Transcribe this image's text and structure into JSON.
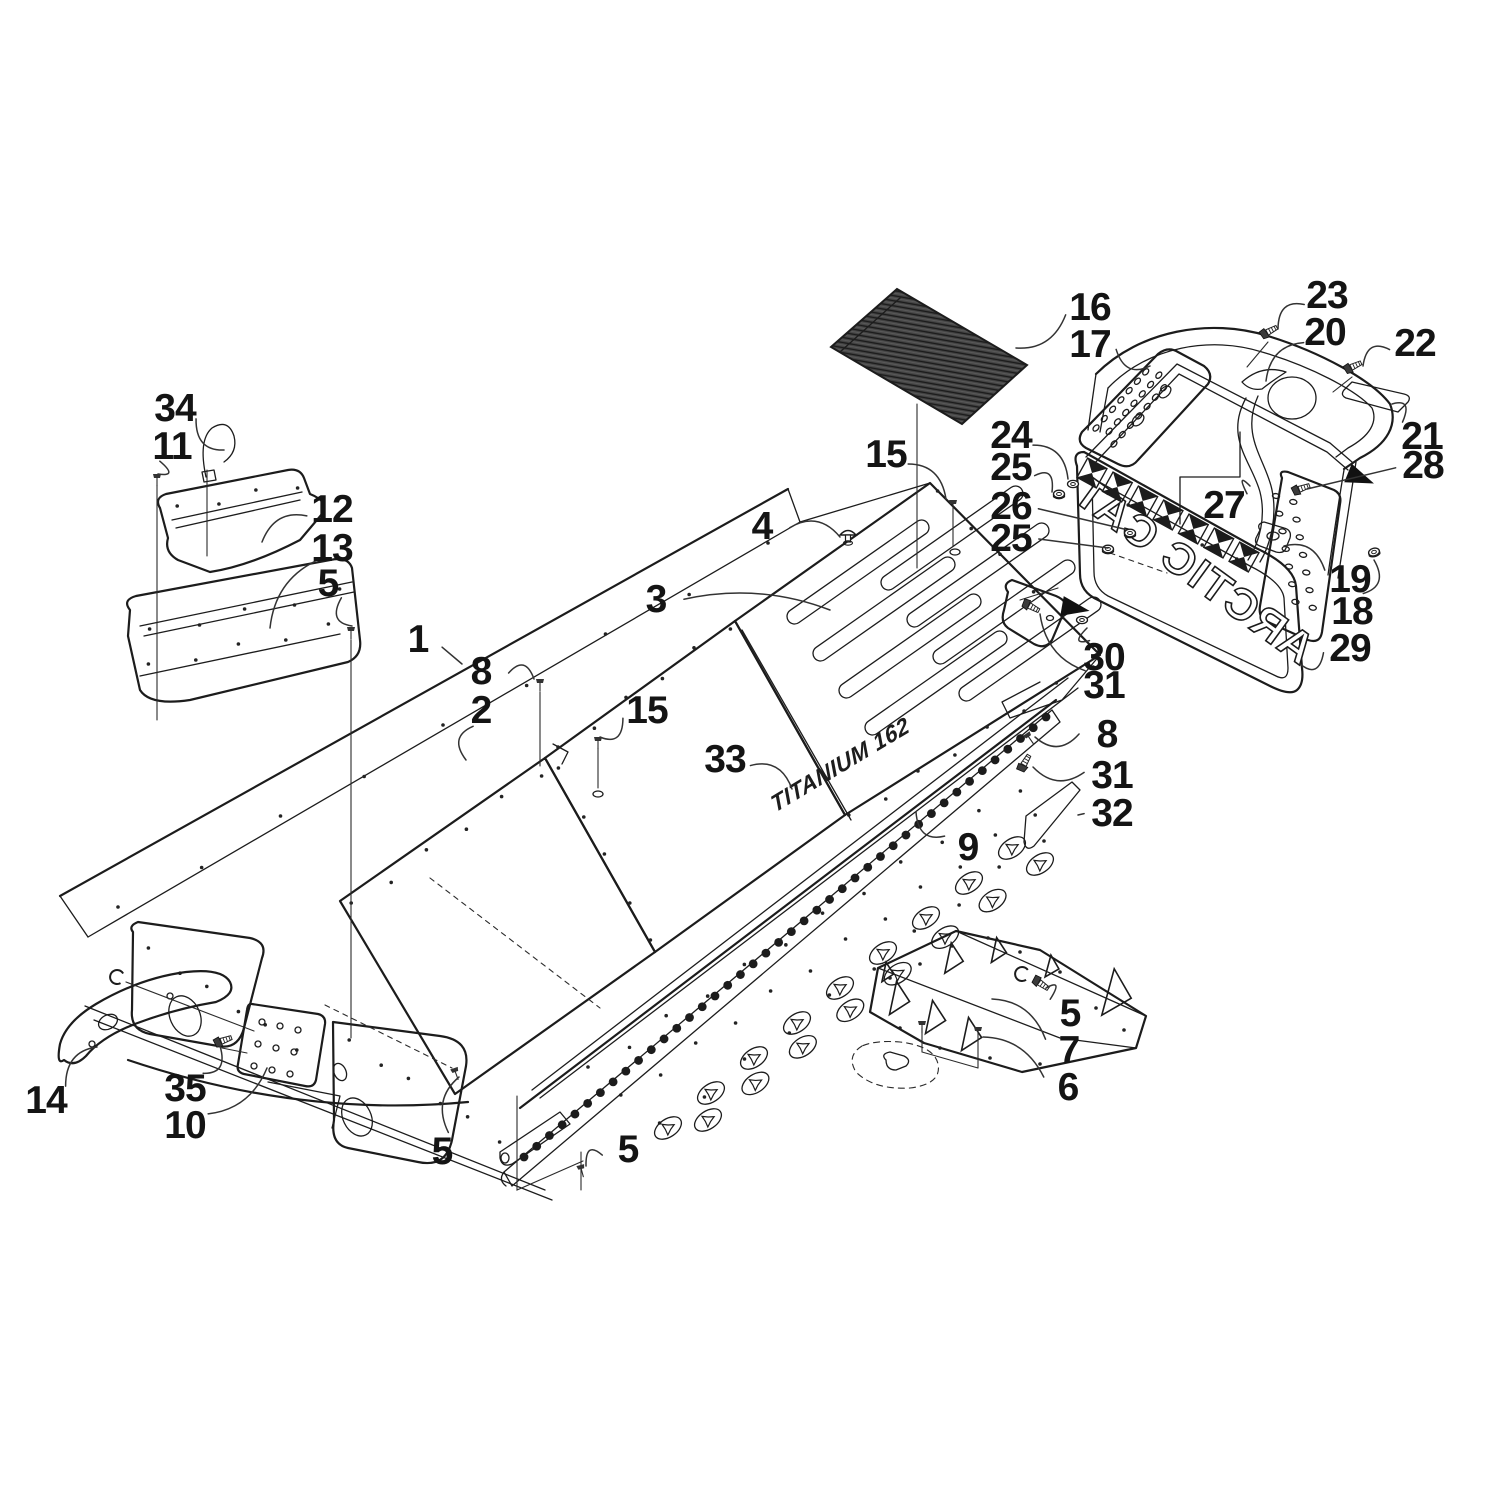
{
  "figure": {
    "type": "exploded-parts-diagram",
    "description": "Tunnel and rear bumper assembly exploded view line drawing",
    "background_color": "#ffffff",
    "line_color": "#1c1c1c",
    "mat_fill_color": "#474747",
    "mat_stripe_color": "#1a1a1a"
  },
  "decals": {
    "flap_logo": "ARCTIC CAT",
    "tunnel_decal": "TITANIUM 162"
  },
  "icons": [
    {
      "name": "direction-arrow-icon",
      "x": 1062,
      "y": 606,
      "angle": 10
    },
    {
      "name": "direction-arrow-icon",
      "x": 1348,
      "y": 473,
      "angle": 22
    }
  ],
  "callouts": [
    {
      "text": "34",
      "x": 175,
      "y": 407,
      "tx": 224,
      "ty": 450,
      "bend": 1
    },
    {
      "text": "11",
      "x": 172,
      "y": 445,
      "tx": 158,
      "ty": 474,
      "bend": -1
    },
    {
      "text": "12",
      "x": 332,
      "y": 508,
      "tx": 262,
      "ty": 542,
      "bend": 1
    },
    {
      "text": "13",
      "x": 332,
      "y": 547,
      "tx": 270,
      "ty": 628,
      "bend": 1
    },
    {
      "text": "5",
      "x": 328,
      "y": 582,
      "tx": 352,
      "ty": 626,
      "bend": 1
    },
    {
      "text": "1",
      "x": 418,
      "y": 638,
      "tx": 462,
      "ty": 664,
      "bend": 0
    },
    {
      "text": "8",
      "x": 481,
      "y": 670,
      "tx": 534,
      "ty": 679,
      "bend": -1
    },
    {
      "text": "2",
      "x": 481,
      "y": 709,
      "tx": 466,
      "ty": 760,
      "bend": 1
    },
    {
      "text": "15",
      "x": 647,
      "y": 709,
      "tx": 600,
      "ty": 737,
      "bend": -1
    },
    {
      "text": "3",
      "x": 656,
      "y": 598,
      "tx": 830,
      "ty": 610,
      "bend": -1
    },
    {
      "text": "4",
      "x": 762,
      "y": 525,
      "tx": 840,
      "ty": 537,
      "bend": -1
    },
    {
      "text": "15",
      "x": 886,
      "y": 453,
      "tx": 946,
      "ty": 499,
      "bend": -1
    },
    {
      "text": "16",
      "x": 1090,
      "y": 306,
      "tx": 1016,
      "ty": 348,
      "bend": -1
    },
    {
      "text": "17",
      "x": 1090,
      "y": 343,
      "tx": 1150,
      "ty": 366,
      "bend": 1
    },
    {
      "text": "23",
      "x": 1327,
      "y": 294,
      "tx": 1278,
      "ty": 329,
      "bend": 1
    },
    {
      "text": "20",
      "x": 1325,
      "y": 331,
      "tx": 1266,
      "ty": 381,
      "bend": 1
    },
    {
      "text": "22",
      "x": 1415,
      "y": 342,
      "tx": 1363,
      "ty": 366,
      "bend": 1
    },
    {
      "text": "21",
      "x": 1422,
      "y": 435,
      "tx": 1392,
      "ty": 404,
      "bend": 1
    },
    {
      "text": "28",
      "x": 1423,
      "y": 464,
      "tx": 1307,
      "ty": 489,
      "bend": 0
    },
    {
      "text": "24",
      "x": 1011,
      "y": 434,
      "tx": 1068,
      "ty": 479,
      "bend": -1
    },
    {
      "text": "25",
      "x": 1011,
      "y": 466,
      "tx": 1052,
      "ty": 492,
      "bend": -1
    },
    {
      "text": "26",
      "x": 1011,
      "y": 505,
      "tx": 1124,
      "ty": 529,
      "bend": 0
    },
    {
      "text": "25",
      "x": 1011,
      "y": 537,
      "tx": 1108,
      "ty": 548,
      "bend": 0
    },
    {
      "text": "27",
      "x": 1224,
      "y": 504,
      "tx": 1250,
      "ty": 486,
      "bend": -1
    },
    {
      "text": "19",
      "x": 1350,
      "y": 578,
      "tx": 1284,
      "ty": 546,
      "bend": 1
    },
    {
      "text": "18",
      "x": 1352,
      "y": 610,
      "tx": 1374,
      "ty": 560,
      "bend": 1
    },
    {
      "text": "29",
      "x": 1350,
      "y": 647,
      "tx": 1300,
      "ty": 664,
      "bend": -1
    },
    {
      "text": "30",
      "x": 1104,
      "y": 656,
      "tx": 1087,
      "ty": 628,
      "bend": -1
    },
    {
      "text": "31",
      "x": 1104,
      "y": 684,
      "tx": 1040,
      "ty": 614,
      "bend": -1
    },
    {
      "text": "8",
      "x": 1107,
      "y": 733,
      "tx": 1035,
      "ty": 737,
      "bend": -1
    },
    {
      "text": "31",
      "x": 1112,
      "y": 774,
      "tx": 1033,
      "ty": 767,
      "bend": -1
    },
    {
      "text": "32",
      "x": 1112,
      "y": 812,
      "tx": 1078,
      "ty": 815,
      "bend": 0
    },
    {
      "text": "33",
      "x": 725,
      "y": 758,
      "tx": 792,
      "ty": 789,
      "bend": -1
    },
    {
      "text": "9",
      "x": 968,
      "y": 846,
      "tx": 916,
      "ty": 812,
      "bend": -1
    },
    {
      "text": "5",
      "x": 1070,
      "y": 1012,
      "tx": 1046,
      "ty": 988,
      "bend": 1
    },
    {
      "text": "7",
      "x": 1069,
      "y": 1049,
      "tx": 992,
      "ty": 999,
      "bend": 1
    },
    {
      "text": "6",
      "x": 1068,
      "y": 1086,
      "tx": 983,
      "ty": 1037,
      "bend": 1
    },
    {
      "text": "14",
      "x": 46,
      "y": 1099,
      "tx": 97,
      "ty": 1047,
      "bend": -1
    },
    {
      "text": "35",
      "x": 185,
      "y": 1087,
      "tx": 220,
      "ty": 1046,
      "bend": 1
    },
    {
      "text": "10",
      "x": 185,
      "y": 1124,
      "tx": 267,
      "ty": 1068,
      "bend": 1
    },
    {
      "text": "5",
      "x": 442,
      "y": 1150,
      "tx": 459,
      "ty": 1077,
      "bend": -1
    },
    {
      "text": "5",
      "x": 628,
      "y": 1148,
      "tx": 586,
      "ty": 1166,
      "bend": 1
    }
  ]
}
